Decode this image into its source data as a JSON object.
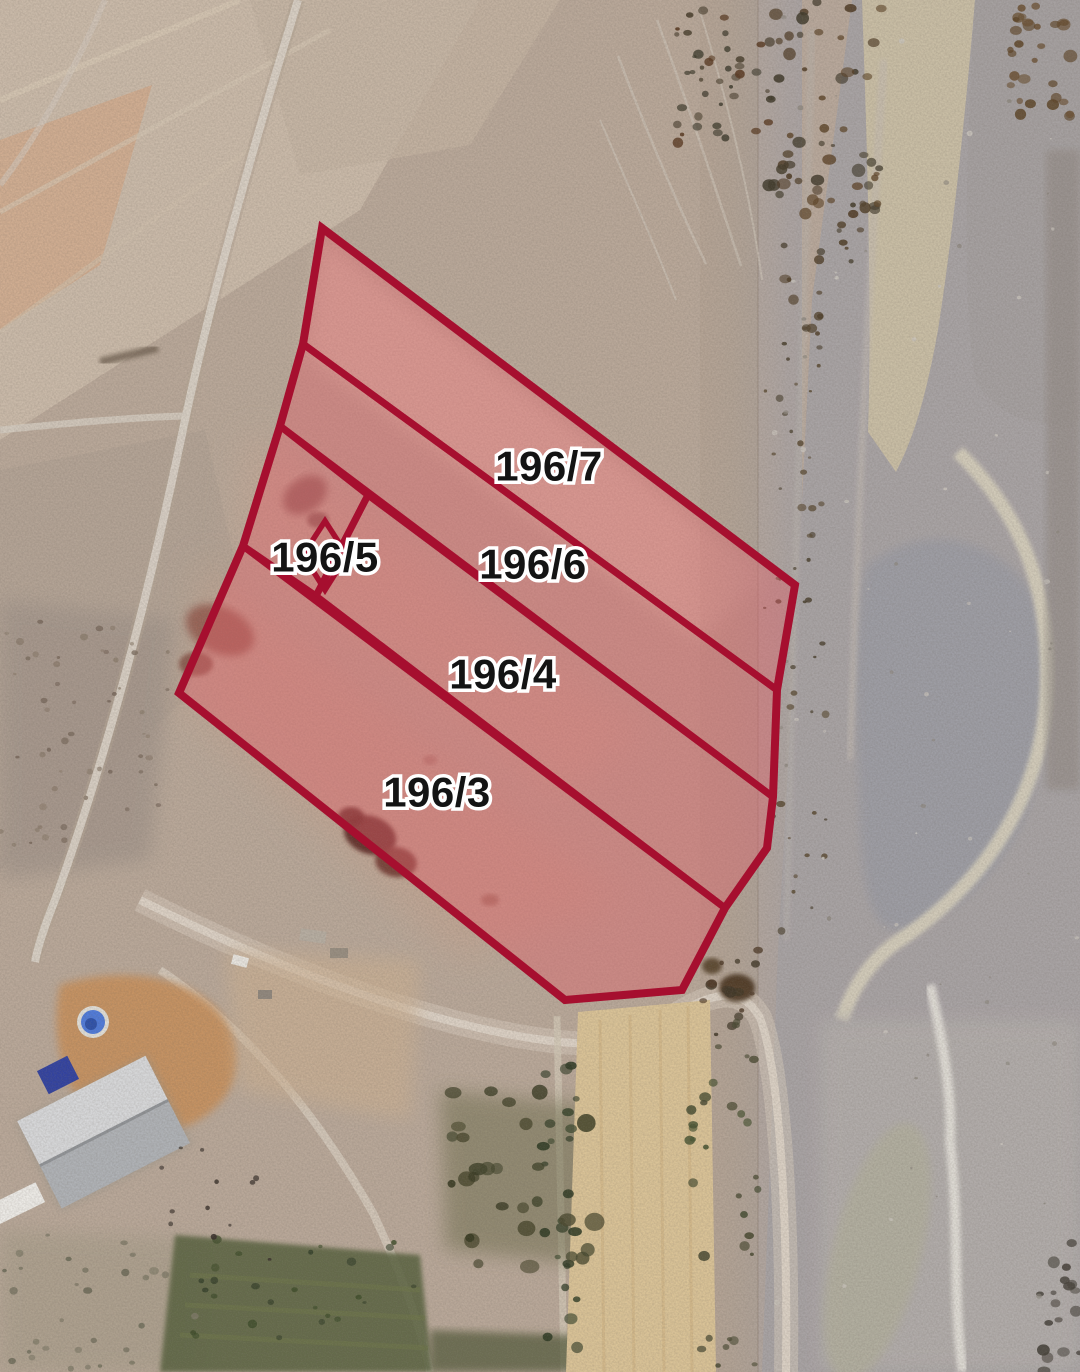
{
  "map": {
    "title": "cadastral-parcel-satellite-overlay",
    "canvas_px": {
      "width": 1080,
      "height": 1372
    },
    "overlay_style": {
      "stroke_color": "#A60F2F",
      "outer_stroke_width": 8,
      "divider_stroke_width": 7,
      "diamond_stroke_width": 5.5,
      "fill_color": "rgba(224,96,106,0.42)",
      "label_font_size": 42,
      "label_fill": "#141414",
      "label_halo": "#ffffff",
      "label_halo_width": 7
    },
    "outer_boundary_px": [
      [
        322,
        228
      ],
      [
        795,
        585
      ],
      [
        777,
        690
      ],
      [
        773,
        797
      ],
      [
        767,
        848
      ],
      [
        725,
        908
      ],
      [
        682,
        990
      ],
      [
        565,
        1000
      ],
      [
        179,
        693
      ],
      [
        243,
        546
      ],
      [
        280,
        426
      ],
      [
        303,
        344
      ]
    ],
    "parcels": [
      {
        "id": "196-7",
        "label": {
          "text": "196/7",
          "x": 549,
          "y": 466
        },
        "points": [
          [
            322,
            228
          ],
          [
            795,
            585
          ],
          [
            777,
            690
          ],
          [
            303,
            344
          ]
        ]
      },
      {
        "id": "196-6",
        "label": {
          "text": "196/6",
          "x": 533,
          "y": 564
        },
        "points": [
          [
            303,
            344
          ],
          [
            777,
            690
          ],
          [
            773,
            797
          ],
          [
            280,
            426
          ]
        ]
      },
      {
        "id": "196-5",
        "label": {
          "text": "196/5",
          "x": 325,
          "y": 557
        },
        "points": [
          [
            280,
            426
          ],
          [
            368,
            495
          ],
          [
            316,
            596
          ],
          [
            243,
            546
          ]
        ]
      },
      {
        "id": "196-4",
        "label": {
          "text": "196/4",
          "x": 503,
          "y": 674
        },
        "points": [
          [
            368,
            495
          ],
          [
            773,
            797
          ],
          [
            767,
            848
          ],
          [
            725,
            908
          ],
          [
            316,
            596
          ]
        ]
      },
      {
        "id": "196-3",
        "label": {
          "text": "196/3",
          "x": 437,
          "y": 792
        },
        "points": [
          [
            243,
            546
          ],
          [
            725,
            908
          ],
          [
            682,
            990
          ],
          [
            565,
            1000
          ],
          [
            179,
            693
          ]
        ]
      }
    ],
    "inner_diamond_px": {
      "parcel": "196-5",
      "points": [
        [
          325,
          521
        ],
        [
          347,
          555
        ],
        [
          325,
          590
        ],
        [
          303,
          555
        ]
      ]
    }
  }
}
